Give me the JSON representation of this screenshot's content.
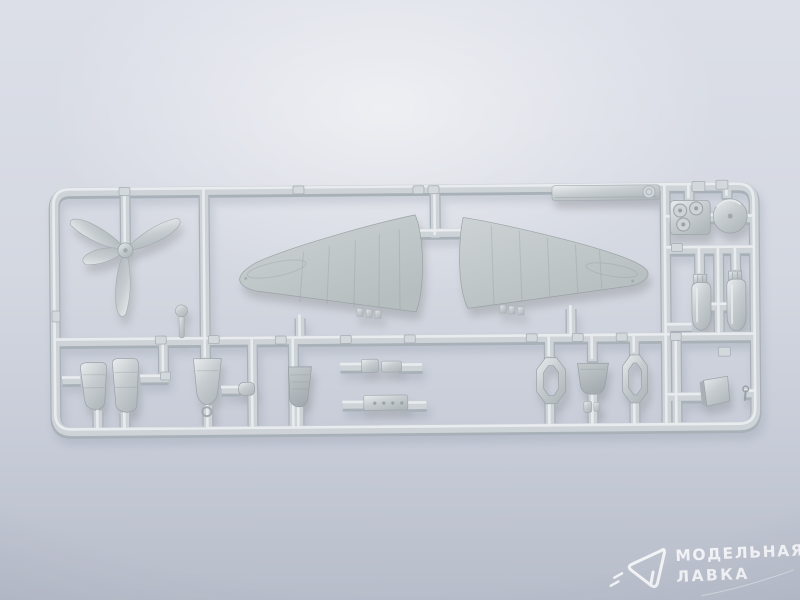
{
  "scene": {
    "type": "product-photo",
    "subject": "Grey injection-moulded plastic model aircraft sprue (parts frame) on a light blue-grey studio background"
  },
  "colors": {
    "bg-top": "#dcdfe8",
    "bg-mid": "#d4d8e1",
    "bg-low": "#c6cbd7",
    "bg-bottom": "#b8bdca",
    "plastic": "#ced3d8",
    "plastic-dark": "#a9b1b8",
    "plastic-light": "#eaedf0",
    "part-fill": "#c6cccf",
    "part-dark": "#b2b9bd",
    "shadow": "#8a93a2",
    "watermark": "#ffffff"
  },
  "watermark": {
    "logo": "paper-plane-outline",
    "line1": "МОДЕЛЬНАЯ",
    "line2": "ЛАВКА"
  },
  "sprue": {
    "material": "matte grey polystyrene",
    "parts": [
      "propeller-4-blade",
      "wing-half-left",
      "wing-half-right",
      "long-spar-strip",
      "engine-crankcase-block",
      "cowl-disc-wheel",
      "bomb-left",
      "bomb-right",
      "cowling-half-1",
      "cowling-half-2",
      "engine-cowl-front",
      "fuselage-cowl-piece",
      "small-fittings-row-1",
      "small-fittings-row-2",
      "cowl-ring-1",
      "cowl-cup",
      "cowl-ring-2",
      "hatch-plate",
      "control-lever",
      "mast-knob"
    ]
  }
}
